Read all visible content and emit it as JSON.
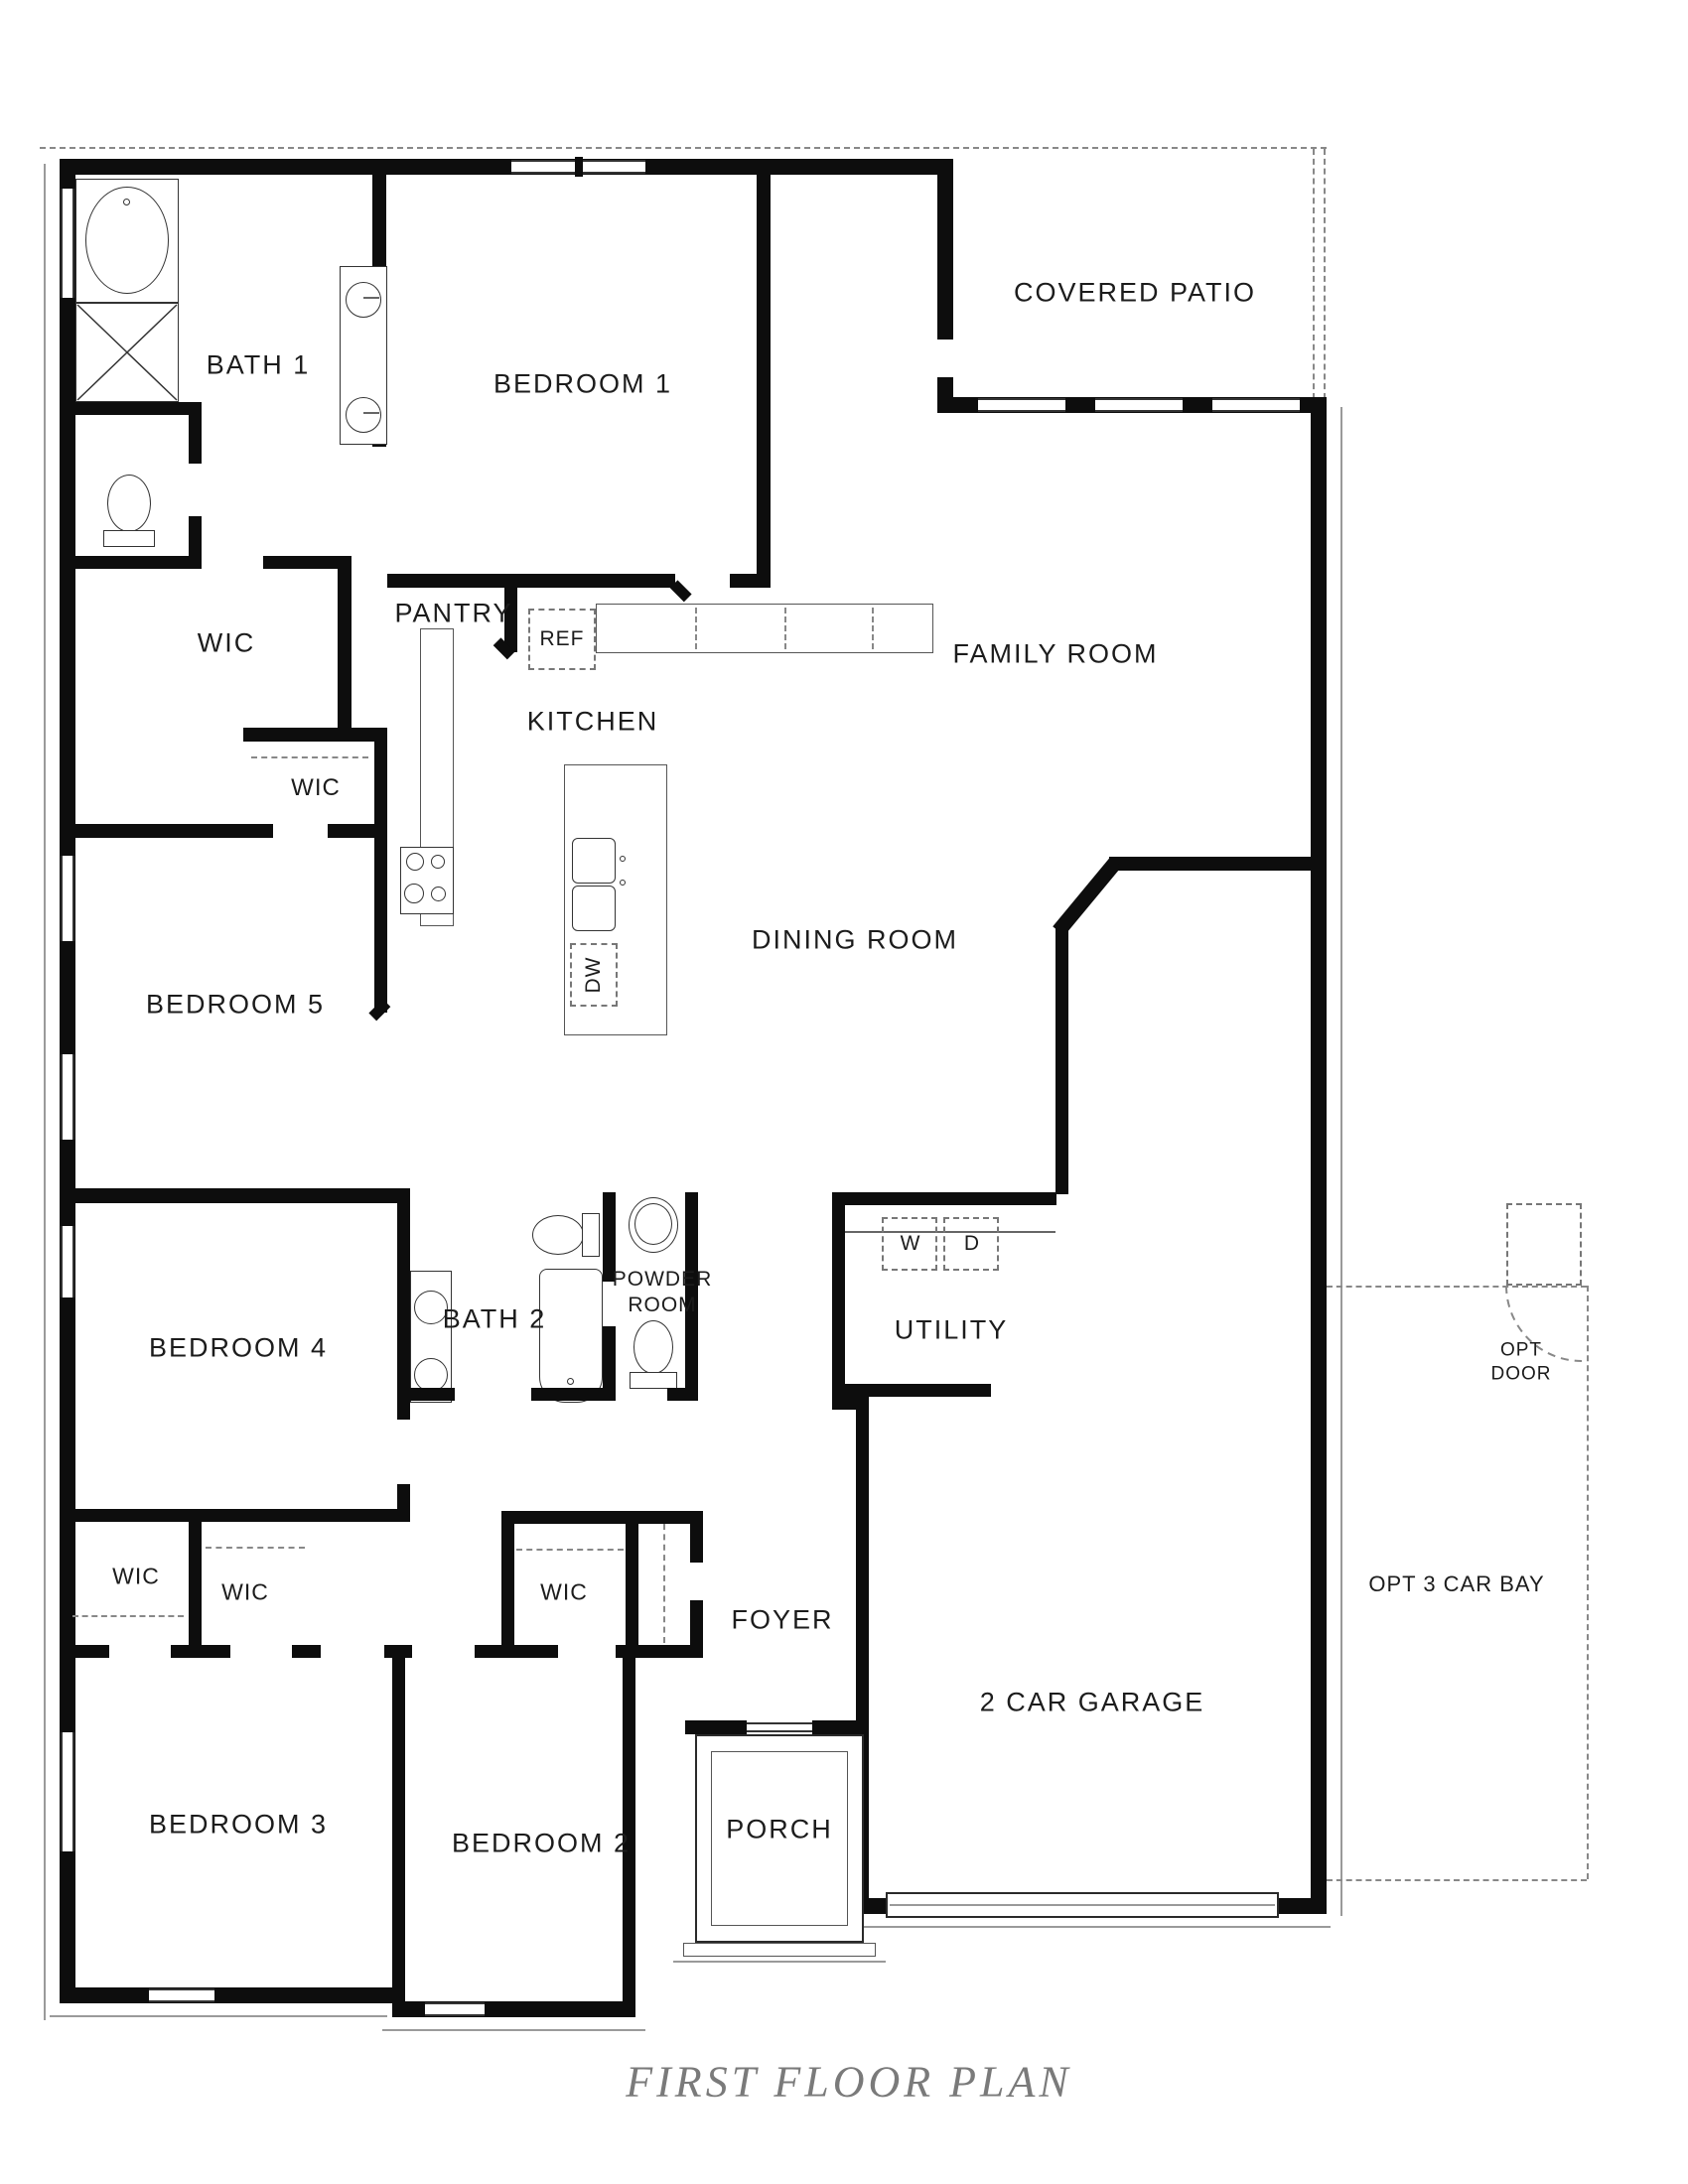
{
  "title": "FIRST FLOOR PLAN",
  "labels": {
    "bath1": "BATH 1",
    "bedroom1": "BEDROOM 1",
    "covered_patio": "COVERED PATIO",
    "wic_main": "WIC",
    "pantry": "PANTRY",
    "ref": "REF",
    "kitchen": "KITCHEN",
    "family_room": "FAMILY ROOM",
    "wic_bed5": "WIC",
    "dining_room": "DINING ROOM",
    "bedroom5": "BEDROOM 5",
    "bedroom4": "BEDROOM 4",
    "bath2": "BATH 2",
    "powder_room": "POWDER ROOM",
    "utility": "UTILITY",
    "washer": "W",
    "dryer": "D",
    "dishwasher": "DW",
    "opt_door": "OPT DOOR",
    "wic_bed3_a": "WIC",
    "wic_bed3_b": "WIC",
    "wic_bed2": "WIC",
    "foyer": "FOYER",
    "garage": "2 CAR GARAGE",
    "opt_3car_bay": "OPT 3 CAR BAY",
    "bedroom3": "BEDROOM 3",
    "bedroom2": "BEDROOM 2",
    "porch": "PORCH"
  }
}
